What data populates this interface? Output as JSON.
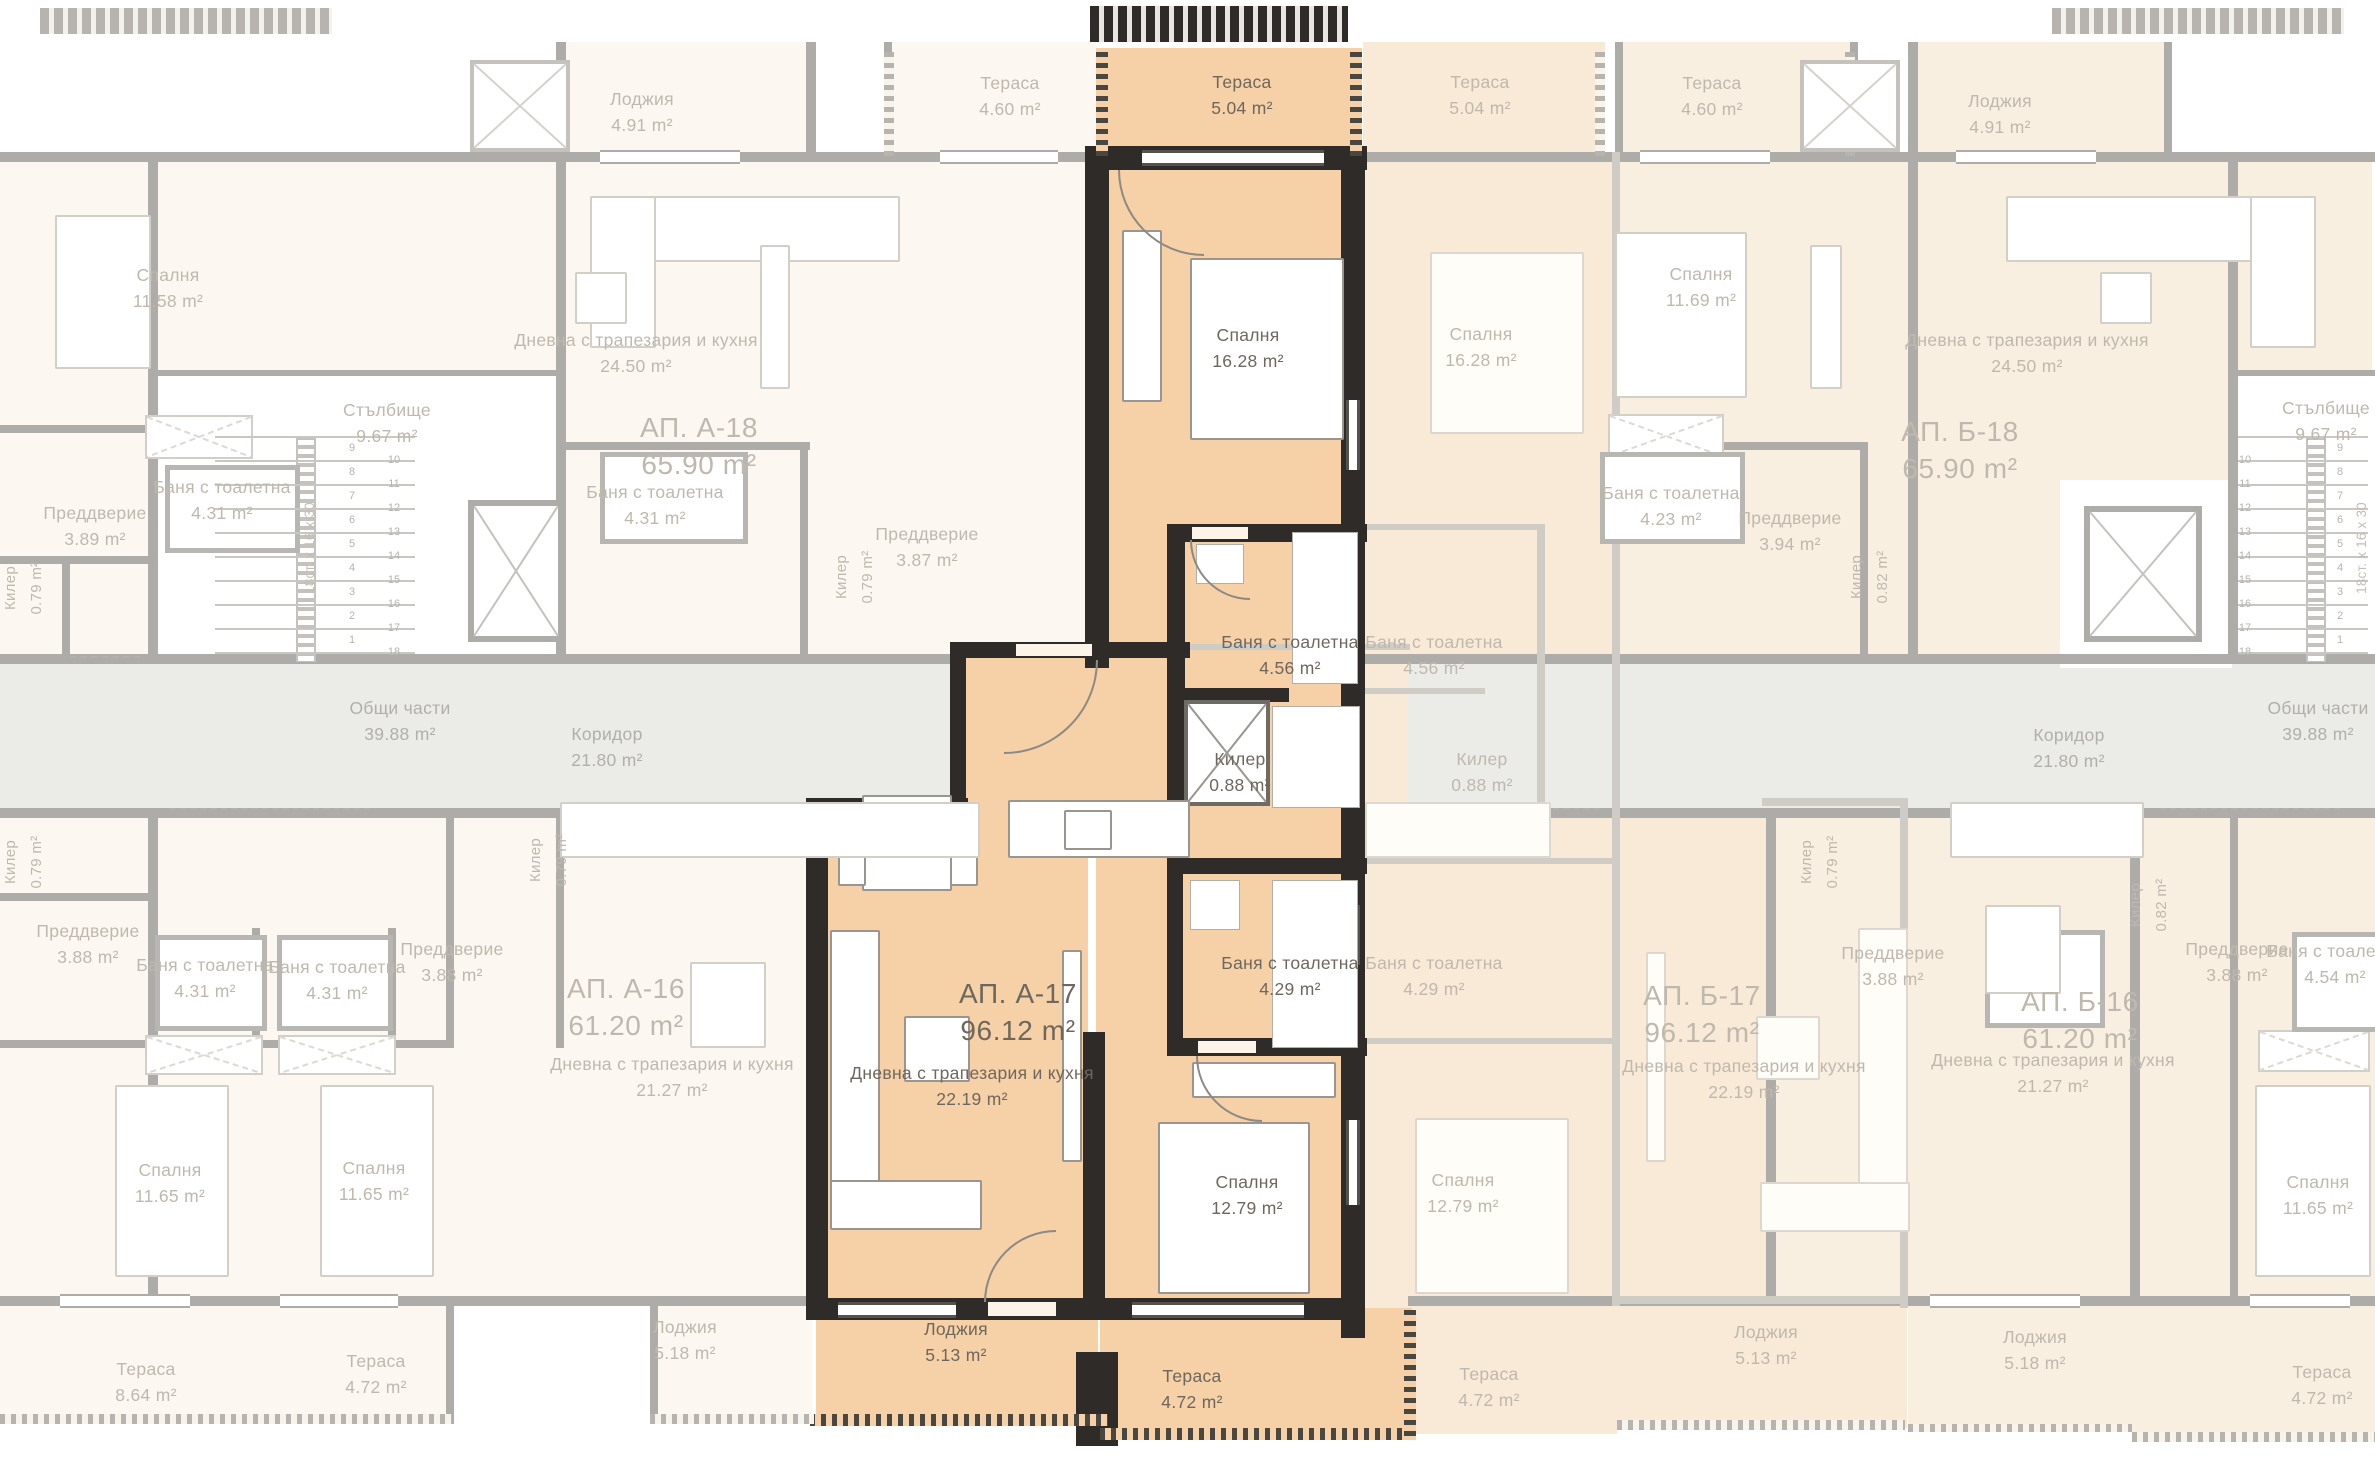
{
  "plan": {
    "type": "residential floor plan",
    "language": "bg",
    "highlighted_apartment": {
      "id": "АП. А-17",
      "total_area": "96.12 m²",
      "rooms": [
        {
          "name": "Тераса",
          "area": "5.04 m²"
        },
        {
          "name": "Спалня",
          "area": "16.28 m²"
        },
        {
          "name": "Баня с тоалетна",
          "area": "4.56 m²"
        },
        {
          "name": "Килер",
          "area": "0.88 m²"
        },
        {
          "name": "Баня с тоалетна",
          "area": "4.29 m²"
        },
        {
          "name": "Дневна с трапезария и кухня",
          "area": "22.19 m²"
        },
        {
          "name": "Спалня",
          "area": "12.79 m²"
        },
        {
          "name": "Лоджия",
          "area": "5.13 m²"
        },
        {
          "name": "Тераса",
          "area": "4.72 m²"
        }
      ]
    },
    "other_apartments": [
      {
        "id": "АП. А-18",
        "total_area": "65.90 m²"
      },
      {
        "id": "АП. Б-18",
        "total_area": "65.90 m²"
      },
      {
        "id": "АП. А-16",
        "total_area": "61.20 m²"
      },
      {
        "id": "АП. Б-17",
        "total_area": "96.12 m²"
      },
      {
        "id": "АП. Б-16",
        "total_area": "61.20 m²"
      }
    ],
    "common_areas": [
      {
        "name": "Коридор",
        "area": "21.80 m²"
      },
      {
        "name": "Общи части",
        "area": "39.88 m²"
      },
      {
        "name": "Стълбище",
        "area": "9.67 m²"
      }
    ],
    "colors": {
      "highlight_fill": "#f6d0a6",
      "highlight_wall": "#2e2b28",
      "faded_fill_cool": "#fcf8f1",
      "faded_fill_warm": "#f9efe1",
      "ghost_fill": "#f8ead6",
      "common_fill": "#ebebe8",
      "faded_wall": "#aeaca8",
      "highlight_text": "#6e675d",
      "faded_text": "#bfb8ad"
    },
    "labels": [
      {
        "room": "Тераса",
        "area": "5.04 m²",
        "x": 1242,
        "y": 95,
        "style": "hl"
      },
      {
        "room": "Спалня",
        "area": "16.28 m²",
        "x": 1248,
        "y": 348,
        "style": "hl"
      },
      {
        "room": "Баня с тоалетна",
        "area": "4.56 m²",
        "x": 1290,
        "y": 655,
        "style": "hl"
      },
      {
        "room": "Килер",
        "area": "0.88 m²",
        "x": 1240,
        "y": 772,
        "style": "hl"
      },
      {
        "room": "Баня с тоалетна",
        "area": "4.29 m²",
        "x": 1290,
        "y": 976,
        "style": "hl"
      },
      {
        "room": "АП. А-17",
        "area": "96.12 m²",
        "x": 1018,
        "y": 1012,
        "style": "hl big"
      },
      {
        "room": "Дневна с трапезария и кухня",
        "area": "22.19 m²",
        "x": 972,
        "y": 1086,
        "style": "hl"
      },
      {
        "room": "Спалня",
        "area": "12.79 m²",
        "x": 1247,
        "y": 1195,
        "style": "hl"
      },
      {
        "room": "Лоджия",
        "area": "5.13 m²",
        "x": 956,
        "y": 1342,
        "style": "hl"
      },
      {
        "room": "Тераса",
        "area": "4.72 m²",
        "x": 1192,
        "y": 1389,
        "style": "hl"
      },
      {
        "room": "Лоджия",
        "area": "4.91 m²",
        "x": 642,
        "y": 112,
        "style": "fd"
      },
      {
        "room": "Тераса",
        "area": "4.60 m²",
        "x": 1010,
        "y": 96,
        "style": "fd"
      },
      {
        "room": "Спалня",
        "area": "11.58 m²",
        "x": 168,
        "y": 288,
        "style": "fd"
      },
      {
        "room": "Дневна с трапезария и кухня",
        "area": "24.50 m²",
        "x": 636,
        "y": 353,
        "style": "fd"
      },
      {
        "room": "АП. А-18",
        "area": "65.90 m²",
        "x": 699,
        "y": 446,
        "style": "fd big"
      },
      {
        "room": "Стълбище",
        "area": "9.67 m²",
        "x": 387,
        "y": 423,
        "style": "fd"
      },
      {
        "room": "Баня с тоалетна",
        "area": "4.31 m²",
        "x": 222,
        "y": 500,
        "style": "fd"
      },
      {
        "room": "Преддверие",
        "area": "3.89 m²",
        "x": 95,
        "y": 526,
        "style": "fd"
      },
      {
        "room": "Баня с тоалетна",
        "area": "4.31 m²",
        "x": 655,
        "y": 505,
        "style": "fd"
      },
      {
        "room": "Преддверие",
        "area": "3.87 m²",
        "x": 927,
        "y": 547,
        "style": "fd"
      },
      {
        "room": "Килер",
        "area": "0.79 m²",
        "x": 855,
        "y": 577,
        "style": "fd vert"
      },
      {
        "room": "Килер",
        "area": "0.79 m²",
        "x": 24,
        "y": 588,
        "style": "fd vert"
      },
      {
        "room": "Общи части",
        "area": "39.88 m²",
        "x": 400,
        "y": 721,
        "style": "cm"
      },
      {
        "room": "Коридор",
        "area": "21.80 m²",
        "x": 607,
        "y": 747,
        "style": "cm"
      },
      {
        "room": "Преддверие",
        "area": "3.88 m²",
        "x": 88,
        "y": 944,
        "style": "fd"
      },
      {
        "room": "Баня с тоалетна",
        "area": "4.31 m²",
        "x": 205,
        "y": 978,
        "style": "fd"
      },
      {
        "room": "Баня с тоалетна",
        "area": "4.31 m²",
        "x": 337,
        "y": 980,
        "style": "fd"
      },
      {
        "room": "Преддверие",
        "area": "3.88 m²",
        "x": 452,
        "y": 962,
        "style": "fd"
      },
      {
        "room": "Килер",
        "area": "0.79 m²",
        "x": 24,
        "y": 862,
        "style": "fd vert"
      },
      {
        "room": "Килер",
        "area": "0.79 m²",
        "x": 549,
        "y": 860,
        "style": "fd vert"
      },
      {
        "room": "АП. А-16",
        "area": "61.20 m²",
        "x": 626,
        "y": 1007,
        "style": "fd big"
      },
      {
        "room": "Дневна с трапезария и кухня",
        "area": "21.27 m²",
        "x": 672,
        "y": 1077,
        "style": "fd"
      },
      {
        "room": "Спалня",
        "area": "11.65 m²",
        "x": 170,
        "y": 1183,
        "style": "fd"
      },
      {
        "room": "Спалня",
        "area": "11.65 m²",
        "x": 374,
        "y": 1181,
        "style": "fd"
      },
      {
        "room": "Тераса",
        "area": "8.64 m²",
        "x": 146,
        "y": 1382,
        "style": "fd"
      },
      {
        "room": "Тераса",
        "area": "4.72 m²",
        "x": 376,
        "y": 1374,
        "style": "fd"
      },
      {
        "room": "Лоджия",
        "area": "5.18 m²",
        "x": 685,
        "y": 1340,
        "style": "fd"
      },
      {
        "room": "Тераса",
        "area": "5.04 m²",
        "x": 1480,
        "y": 95,
        "style": "fd"
      },
      {
        "room": "Спалня",
        "area": "16.28 m²",
        "x": 1481,
        "y": 347,
        "style": "fd"
      },
      {
        "room": "Баня с тоалетна",
        "area": "4.56 m²",
        "x": 1434,
        "y": 655,
        "style": "fd"
      },
      {
        "room": "Килер",
        "area": "0.88 m²",
        "x": 1482,
        "y": 772,
        "style": "fd"
      },
      {
        "room": "Баня с тоалетна",
        "area": "4.29 m²",
        "x": 1434,
        "y": 976,
        "style": "fd"
      },
      {
        "room": "АП. Б-17",
        "area": "96.12 m²",
        "x": 1702,
        "y": 1014,
        "style": "fd big"
      },
      {
        "room": "Дневна с трапезария и кухня",
        "area": "22.19 m²",
        "x": 1744,
        "y": 1079,
        "style": "fd"
      },
      {
        "room": "Спалня",
        "area": "12.79 m²",
        "x": 1463,
        "y": 1193,
        "style": "fd"
      },
      {
        "room": "Тераса",
        "area": "4.72 m²",
        "x": 1489,
        "y": 1387,
        "style": "fd"
      },
      {
        "room": "Лоджия",
        "area": "5.13 m²",
        "x": 1766,
        "y": 1345,
        "style": "fd"
      },
      {
        "room": "Тераса",
        "area": "4.60 m²",
        "x": 1712,
        "y": 96,
        "style": "fd"
      },
      {
        "room": "Лоджия",
        "area": "4.91 m²",
        "x": 2000,
        "y": 114,
        "style": "fd"
      },
      {
        "room": "Спалня",
        "area": "11.69 m²",
        "x": 1701,
        "y": 287,
        "style": "fd"
      },
      {
        "room": "Дневна с трапезария и кухня",
        "area": "24.50 m²",
        "x": 2027,
        "y": 353,
        "style": "fd"
      },
      {
        "room": "АП. Б-18",
        "area": "65.90 m²",
        "x": 1960,
        "y": 450,
        "style": "fd big"
      },
      {
        "room": "Стълбище",
        "area": "9.67 m²",
        "x": 2326,
        "y": 421,
        "style": "fd"
      },
      {
        "room": "Баня с тоалетна",
        "area": "4.23 m²",
        "x": 1671,
        "y": 506,
        "style": "fd"
      },
      {
        "room": "Преддверие",
        "area": "3.94 m²",
        "x": 1790,
        "y": 531,
        "style": "fd"
      },
      {
        "room": "Килер",
        "area": "0.82 m²",
        "x": 1870,
        "y": 577,
        "style": "fd vert"
      },
      {
        "room": "Коридор",
        "area": "21.80 m²",
        "x": 2069,
        "y": 748,
        "style": "cm"
      },
      {
        "room": "Общи части",
        "area": "39.88 m²",
        "x": 2318,
        "y": 721,
        "style": "cm"
      },
      {
        "room": "Преддверие",
        "area": "3.88 m²",
        "x": 1893,
        "y": 966,
        "style": "fd"
      },
      {
        "room": "Килер",
        "area": "0.79 m²",
        "x": 1820,
        "y": 862,
        "style": "fd vert"
      },
      {
        "room": "Килер",
        "area": "0.82 m²",
        "x": 2149,
        "y": 905,
        "style": "fd vert"
      },
      {
        "room": "Преддверие",
        "area": "3.88 m²",
        "x": 2237,
        "y": 962,
        "style": "fd"
      },
      {
        "room": "Баня с тоалетна",
        "area": "4.54 m²",
        "x": 2335,
        "y": 964,
        "style": "fd"
      },
      {
        "room": "АП. Б-16",
        "area": "61.20 m²",
        "x": 2080,
        "y": 1020,
        "style": "fd big"
      },
      {
        "room": "Дневна с трапезария и кухня",
        "area": "21.27 m²",
        "x": 2053,
        "y": 1073,
        "style": "fd"
      },
      {
        "room": "Спалня",
        "area": "11.65 m²",
        "x": 2318,
        "y": 1195,
        "style": "fd"
      },
      {
        "room": "Лоджия",
        "area": "5.18 m²",
        "x": 2035,
        "y": 1350,
        "style": "fd"
      },
      {
        "room": "Тераса",
        "area": "4.72 m²",
        "x": 2322,
        "y": 1385,
        "style": "fd"
      },
      {
        "room": "18ст. х 16 х 30",
        "x": 310,
        "y": 548,
        "style": "note vert"
      },
      {
        "room": "18ст. х 16 х 30",
        "x": 2362,
        "y": 548,
        "style": "note vert"
      }
    ],
    "stairwells": [
      {
        "side": "left",
        "label": "Стълбище",
        "area": "9.67 m²",
        "step_note": "18ст. х 16 х 30",
        "treads": {
          "x": 215,
          "w": 200,
          "y0": 436,
          "dy": 24,
          "count": 10
        },
        "number_cols": [
          {
            "x": 352,
            "y0": 448,
            "dy": 24,
            "values": [
              "9",
              "8",
              "7",
              "6",
              "5",
              "4",
              "3",
              "2",
              "1"
            ]
          },
          {
            "x": 394,
            "y0": 460,
            "dy": 24,
            "values": [
              "10",
              "11",
              "12",
              "13",
              "14",
              "15",
              "16",
              "17",
              "18"
            ]
          }
        ]
      },
      {
        "side": "right",
        "label": "Стълбище",
        "area": "9.67 m²",
        "step_note": "18ст. х 16 х 30",
        "treads": {
          "x": 2238,
          "w": 130,
          "y0": 436,
          "dy": 24,
          "count": 10
        },
        "number_cols": [
          {
            "x": 2340,
            "y0": 448,
            "dy": 24,
            "values": [
              "9",
              "8",
              "7",
              "6",
              "5",
              "4",
              "3",
              "2",
              "1"
            ]
          },
          {
            "x": 2245,
            "y0": 460,
            "dy": 24,
            "values": [
              "10",
              "11",
              "12",
              "13",
              "14",
              "15",
              "16",
              "17",
              "18"
            ]
          }
        ]
      }
    ]
  }
}
